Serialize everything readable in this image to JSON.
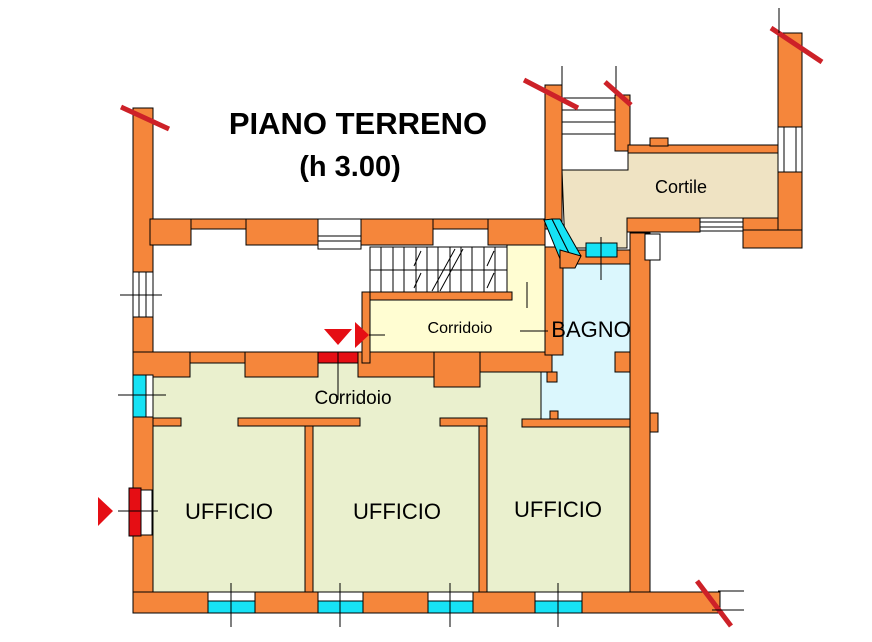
{
  "title": {
    "line1": "PIANO TERRENO",
    "line2": "(h 3.00)"
  },
  "rooms": {
    "cortile": "Cortile",
    "corridoio_upper": "Corridoio",
    "bagno": "BAGNO",
    "corridoio_lower": "Corridoio",
    "ufficio": "UFFICIO"
  },
  "palette": {
    "wall": "#F5863B",
    "cortile": "#EFE3C3",
    "corridor": "#FFFDD2",
    "office": "#EAF0CE",
    "bagno": "#DBF7FD",
    "window_cyan": "#16E2F5",
    "door_red": "#E50E14",
    "cut_red": "#CD2128",
    "line": "#000000",
    "background": "#FFFFFF"
  }
}
